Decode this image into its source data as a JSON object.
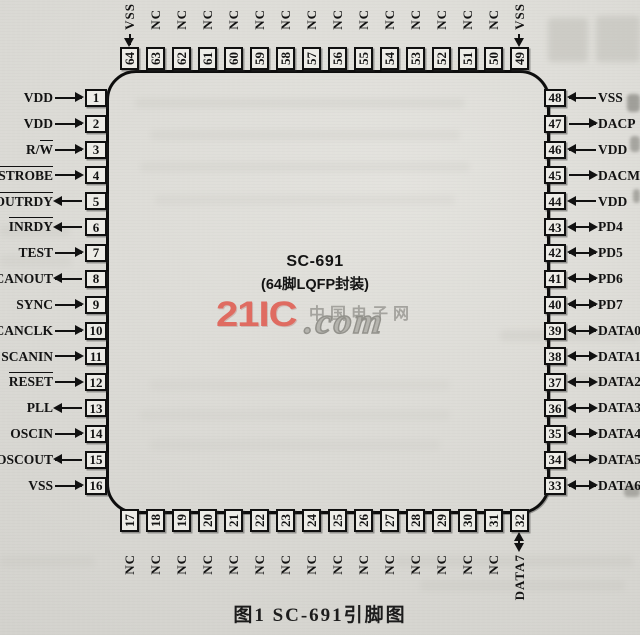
{
  "figure": {
    "caption": "图1  SC-691引脚图"
  },
  "chip": {
    "name": "SC-691",
    "package": "(64脚LQFP封装)"
  },
  "watermark": {
    "brand": "21IC",
    "site": "中国电子网",
    "domain": ".com"
  },
  "colors": {
    "paper": "#dcdbd6",
    "ink": "#111111",
    "watermark_red": "#e0665b",
    "watermark_gray": "#9e9d98"
  },
  "pins": {
    "top": [
      {
        "num": 64,
        "label": "VSS",
        "ov": "",
        "dir": "in"
      },
      {
        "num": 63,
        "label": "NC",
        "ov": "",
        "dir": "none"
      },
      {
        "num": 62,
        "label": "NC",
        "ov": "",
        "dir": "none"
      },
      {
        "num": 61,
        "label": "NC",
        "ov": "",
        "dir": "none"
      },
      {
        "num": 60,
        "label": "NC",
        "ov": "",
        "dir": "none"
      },
      {
        "num": 59,
        "label": "NC",
        "ov": "",
        "dir": "none"
      },
      {
        "num": 58,
        "label": "NC",
        "ov": "",
        "dir": "none"
      },
      {
        "num": 57,
        "label": "NC",
        "ov": "",
        "dir": "none"
      },
      {
        "num": 56,
        "label": "NC",
        "ov": "",
        "dir": "none"
      },
      {
        "num": 55,
        "label": "NC",
        "ov": "",
        "dir": "none"
      },
      {
        "num": 54,
        "label": "NC",
        "ov": "",
        "dir": "none"
      },
      {
        "num": 53,
        "label": "NC",
        "ov": "",
        "dir": "none"
      },
      {
        "num": 52,
        "label": "NC",
        "ov": "",
        "dir": "none"
      },
      {
        "num": 51,
        "label": "NC",
        "ov": "",
        "dir": "none"
      },
      {
        "num": 50,
        "label": "NC",
        "ov": "",
        "dir": "none"
      },
      {
        "num": 49,
        "label": "VSS",
        "ov": "",
        "dir": "in"
      }
    ],
    "left": [
      {
        "num": 1,
        "label": "VDD",
        "ov": "",
        "dir": "in"
      },
      {
        "num": 2,
        "label": "VDD",
        "ov": "",
        "dir": "in"
      },
      {
        "num": 3,
        "label": "R/",
        "ov": "W",
        "dir": "in"
      },
      {
        "num": 4,
        "label": "",
        "ov": "STROBE",
        "dir": "in"
      },
      {
        "num": 5,
        "label": "",
        "ov": "OUTRDY",
        "dir": "out"
      },
      {
        "num": 6,
        "label": "",
        "ov": "INRDY",
        "dir": "out"
      },
      {
        "num": 7,
        "label": "TEST",
        "ov": "",
        "dir": "in"
      },
      {
        "num": 8,
        "label": "SCANOUT",
        "ov": "",
        "dir": "out"
      },
      {
        "num": 9,
        "label": "SYNC",
        "ov": "",
        "dir": "in"
      },
      {
        "num": 10,
        "label": "SCANCLK",
        "ov": "",
        "dir": "in"
      },
      {
        "num": 11,
        "label": "SCANIN",
        "ov": "",
        "dir": "in"
      },
      {
        "num": 12,
        "label": "",
        "ov": "RESET",
        "dir": "in"
      },
      {
        "num": 13,
        "label": "PLL",
        "ov": "",
        "dir": "out"
      },
      {
        "num": 14,
        "label": "OSCIN",
        "ov": "",
        "dir": "in"
      },
      {
        "num": 15,
        "label": "OSCOUT",
        "ov": "",
        "dir": "out"
      },
      {
        "num": 16,
        "label": "VSS",
        "ov": "",
        "dir": "in"
      }
    ],
    "right": [
      {
        "num": 48,
        "label": "VSS",
        "ov": "",
        "dir": "in"
      },
      {
        "num": 47,
        "label": "DACP",
        "ov": "",
        "dir": "out"
      },
      {
        "num": 46,
        "label": "VDD",
        "ov": "",
        "dir": "in"
      },
      {
        "num": 45,
        "label": "DACM",
        "ov": "",
        "dir": "out"
      },
      {
        "num": 44,
        "label": "VDD",
        "ov": "",
        "dir": "in"
      },
      {
        "num": 43,
        "label": "PD4",
        "ov": "",
        "dir": "bidi"
      },
      {
        "num": 42,
        "label": "PD5",
        "ov": "",
        "dir": "bidi"
      },
      {
        "num": 41,
        "label": "PD6",
        "ov": "",
        "dir": "bidi"
      },
      {
        "num": 40,
        "label": "PD7",
        "ov": "",
        "dir": "bidi"
      },
      {
        "num": 39,
        "label": "DATA0",
        "ov": "",
        "dir": "bidi"
      },
      {
        "num": 38,
        "label": "DATA1",
        "ov": "",
        "dir": "bidi"
      },
      {
        "num": 37,
        "label": "DATA2",
        "ov": "",
        "dir": "bidi"
      },
      {
        "num": 36,
        "label": "DATA3",
        "ov": "",
        "dir": "bidi"
      },
      {
        "num": 35,
        "label": "DATA4",
        "ov": "",
        "dir": "bidi"
      },
      {
        "num": 34,
        "label": "DATA5",
        "ov": "",
        "dir": "bidi"
      },
      {
        "num": 33,
        "label": "DATA6",
        "ov": "",
        "dir": "bidi"
      }
    ],
    "bottom": [
      {
        "num": 17,
        "label": "NC",
        "ov": "",
        "dir": "none"
      },
      {
        "num": 18,
        "label": "NC",
        "ov": "",
        "dir": "none"
      },
      {
        "num": 19,
        "label": "NC",
        "ov": "",
        "dir": "none"
      },
      {
        "num": 20,
        "label": "NC",
        "ov": "",
        "dir": "none"
      },
      {
        "num": 21,
        "label": "NC",
        "ov": "",
        "dir": "none"
      },
      {
        "num": 22,
        "label": "NC",
        "ov": "",
        "dir": "none"
      },
      {
        "num": 23,
        "label": "NC",
        "ov": "",
        "dir": "none"
      },
      {
        "num": 24,
        "label": "NC",
        "ov": "",
        "dir": "none"
      },
      {
        "num": 25,
        "label": "NC",
        "ov": "",
        "dir": "none"
      },
      {
        "num": 26,
        "label": "NC",
        "ov": "",
        "dir": "none"
      },
      {
        "num": 27,
        "label": "NC",
        "ov": "",
        "dir": "none"
      },
      {
        "num": 28,
        "label": "NC",
        "ov": "",
        "dir": "none"
      },
      {
        "num": 29,
        "label": "NC",
        "ov": "",
        "dir": "none"
      },
      {
        "num": 30,
        "label": "NC",
        "ov": "",
        "dir": "none"
      },
      {
        "num": 31,
        "label": "NC",
        "ov": "",
        "dir": "none"
      },
      {
        "num": 32,
        "label": "DATA7",
        "ov": "",
        "dir": "bidi"
      }
    ]
  }
}
